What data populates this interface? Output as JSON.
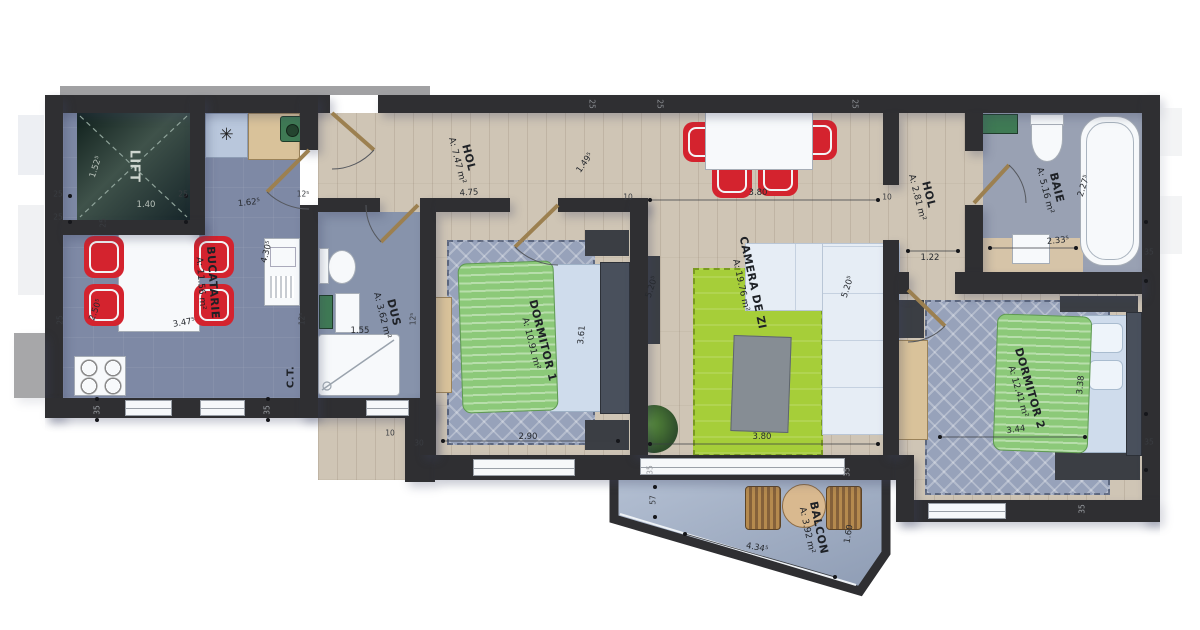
{
  "plan_title": "Apartment floor plan",
  "rooms": {
    "lift": {
      "name": "LIFT"
    },
    "bucatarie": {
      "name": "BUCATARIE",
      "area": "A: 11.56 m²"
    },
    "hol1": {
      "name": "HOL",
      "area": "A: 7.47 m²"
    },
    "dus": {
      "name": "DUS",
      "area": "A: 3.62 m²"
    },
    "ct": {
      "name": "C.T."
    },
    "dormitor1": {
      "name": "DORMITOR 1",
      "area": "A: 10.91 m²"
    },
    "camera_de_zi": {
      "name": "CAMERA DE ZI",
      "area": "A: 19.76 m²"
    },
    "hol2": {
      "name": "HOL",
      "area": "A: 2.81 m²"
    },
    "baie": {
      "name": "BAIE",
      "area": "A: 5.16 m²"
    },
    "dormitor2": {
      "name": "DORMITOR 2",
      "area": "A: 12.41 m²"
    },
    "balcon": {
      "name": "BALCON",
      "area": "A: 3.92 m²"
    }
  },
  "dims": {
    "lift_width": "1.40",
    "lift_depth": "1.52⁵",
    "bucatarie_width": "3.47⁵",
    "bucatarie_depth": "2.50⁵",
    "bucatarie_door": "1.62⁵",
    "bucatarie_side": "4.30⁵",
    "hol1_width": "4.75",
    "hol1_diag": "1.49⁵",
    "dus_width": "1.55",
    "dormitor1_width": "2.90",
    "dormitor1_depth": "3.61",
    "camera_width_top": "3.80",
    "camera_width_bottom": "3.80",
    "camera_depth_left": "5.20⁵",
    "camera_depth_right": "5.20⁵",
    "hol2_width": "1.22",
    "baie_depth": "2.27⁵",
    "baie_width": "2.33⁵",
    "dormitor2_depth": "3.38",
    "dormitor2_width": "3.44",
    "balcon_width": "4.34⁵",
    "balcon_depth": "1.60"
  },
  "wall_markers": {
    "w25": "25",
    "w35": "35",
    "w30": "30",
    "w10": "10",
    "w12": "12⁵",
    "w57": "57"
  },
  "colors": {
    "wall": "#2f2f32",
    "wood_floor": "#cfc5b5",
    "blue_floor": "#7e89a5",
    "rug_blue": "#97a2ba",
    "rug_green": "#a6ce39",
    "duvet_green": "#8cc979",
    "chair_red": "#d4232e",
    "sofa": "#e6edf5",
    "balcony_floor": "#a9b6ca"
  }
}
